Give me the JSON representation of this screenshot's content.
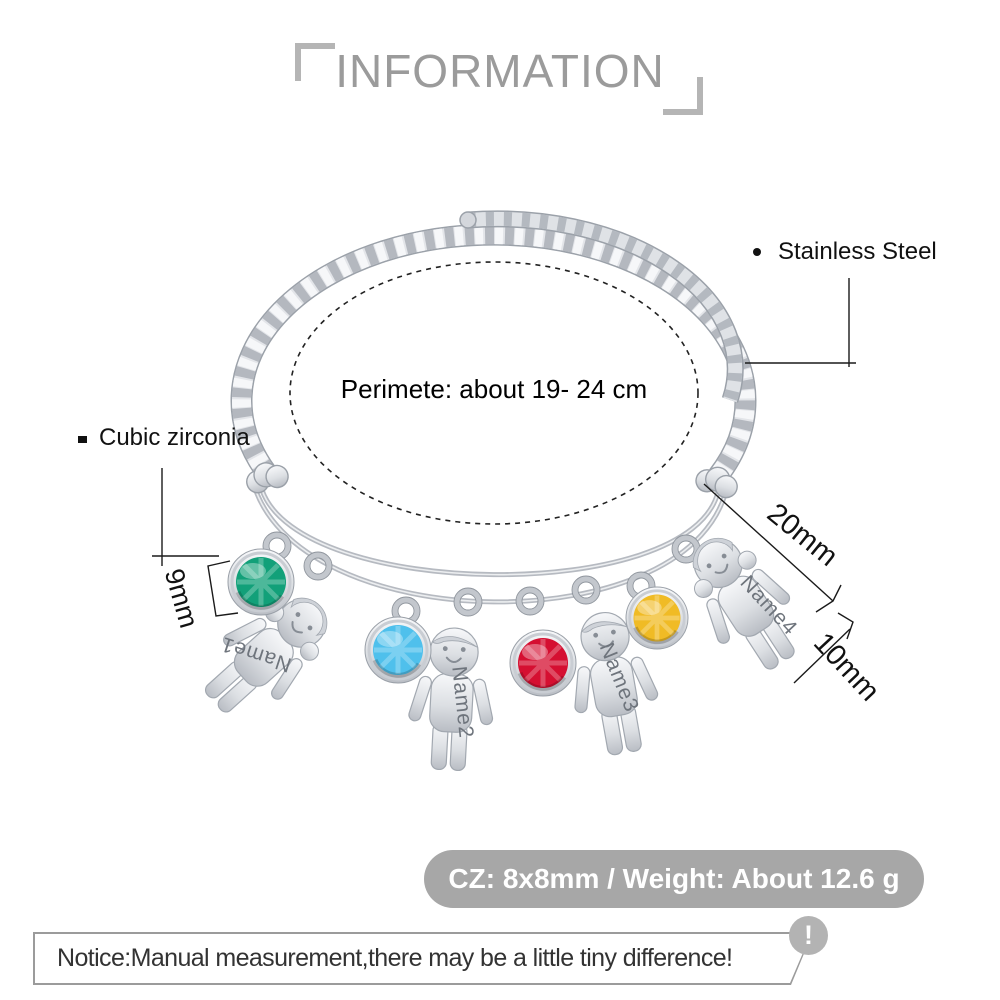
{
  "header": {
    "title": "INFORMATION"
  },
  "product": {
    "material_label": "Stainless Steel",
    "stone_material_label": "Cubic zirconia",
    "perimeter_label": "Perimete: about  19- 24 cm",
    "charm_names": [
      "Name1",
      "Name2",
      "Name3",
      "Name4"
    ],
    "dimensions": {
      "stone_diameter": "9mm",
      "charm_height": "20mm",
      "charm_width": "10mm"
    },
    "stone_colors": {
      "green": "#12a079",
      "blue": "#4fc0ec",
      "red": "#d50f31",
      "yellow": "#f0bb25"
    }
  },
  "spec_banner": {
    "text": "CZ: 8x8mm / Weight: About 12.6 g"
  },
  "notice": {
    "text": "Notice:Manual measurement,there may be a little tiny difference!",
    "icon_glyph": "!"
  }
}
